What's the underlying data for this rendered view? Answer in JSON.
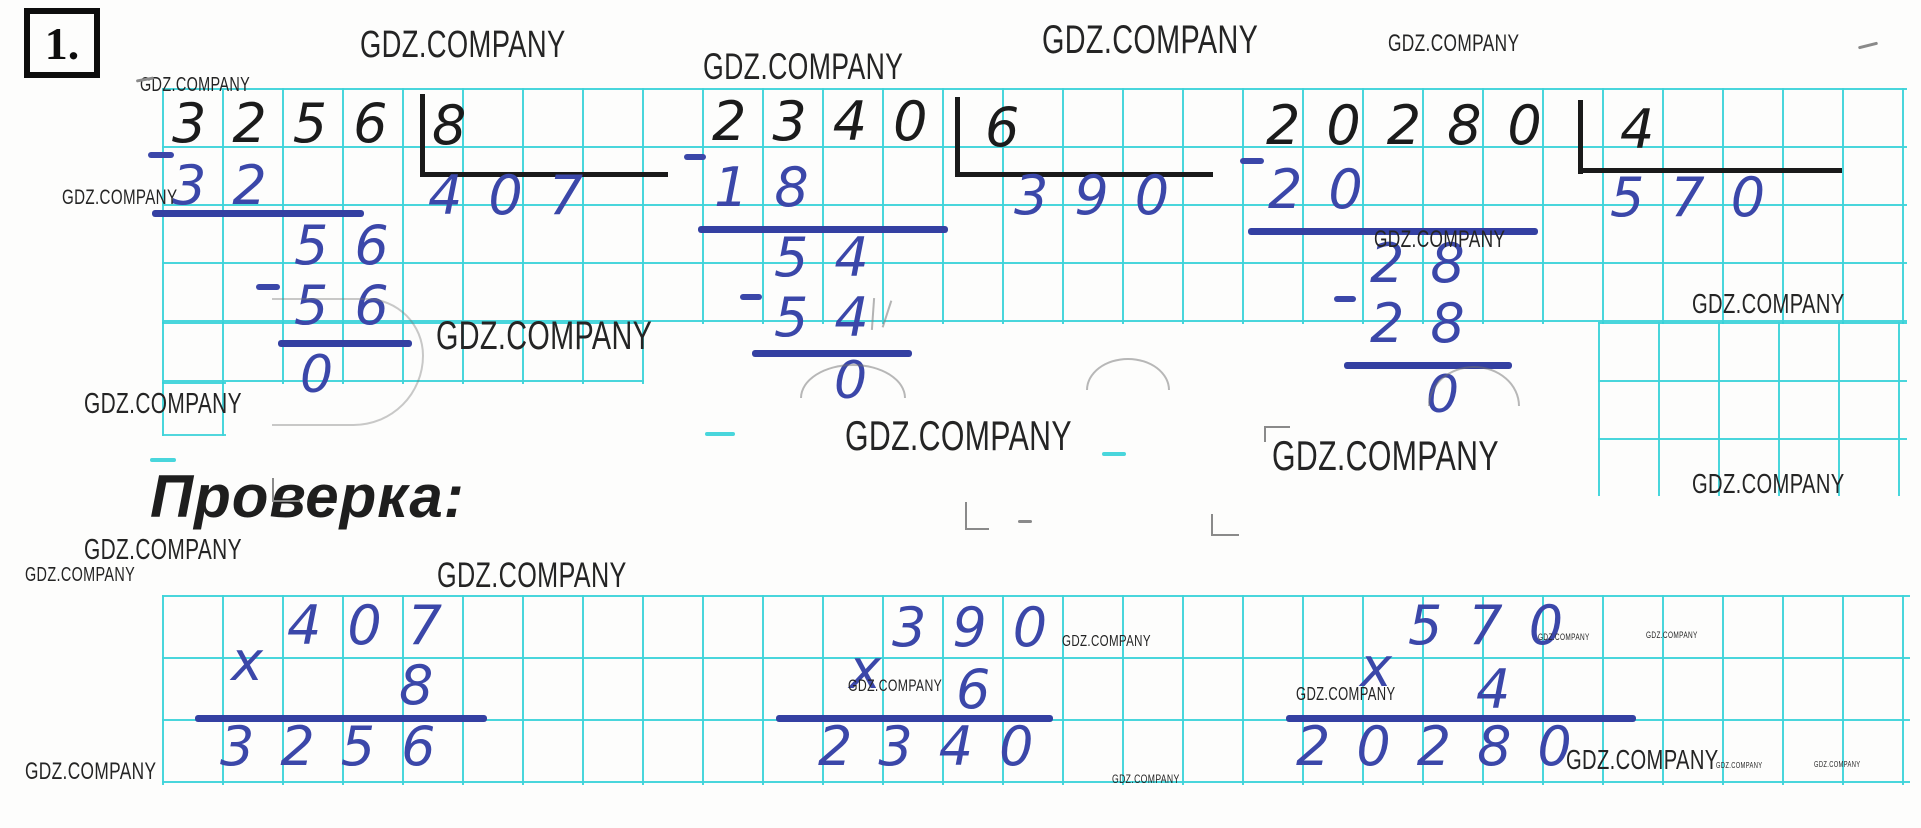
{
  "page": {
    "task_number": "1.",
    "watermark": "GDZ.COMPANY",
    "verification_heading": "Проверка:"
  },
  "divisions": [
    {
      "dividend": "3256",
      "divisor": "8",
      "quotient": "407",
      "step1": "32",
      "step2": "56",
      "step3": "56",
      "remainder": "0"
    },
    {
      "dividend": "2340",
      "divisor": "6",
      "quotient": "390",
      "step1": "18",
      "step2": "54",
      "step3": "54",
      "remainder": "0"
    },
    {
      "dividend": "20280",
      "divisor": "4",
      "quotient": "570",
      "step1": "20",
      "step2": "28",
      "step3": "28",
      "remainder": "0"
    }
  ],
  "multiplications": [
    {
      "sign": "x",
      "multiplicand": "407",
      "multiplier": "8",
      "product": "3256"
    },
    {
      "sign": "x",
      "multiplicand": "390",
      "multiplier": "6",
      "product": "2340"
    },
    {
      "sign": "x",
      "multiplicand": "570",
      "multiplier": "4",
      "product": "20280"
    }
  ],
  "colors": {
    "grid_cyan": "#35d2d8",
    "ink_blue": "#3b47a9",
    "rule_blue": "#3440a2",
    "ink_black": "#1b1b1b",
    "watermark_gray": "#242424"
  }
}
